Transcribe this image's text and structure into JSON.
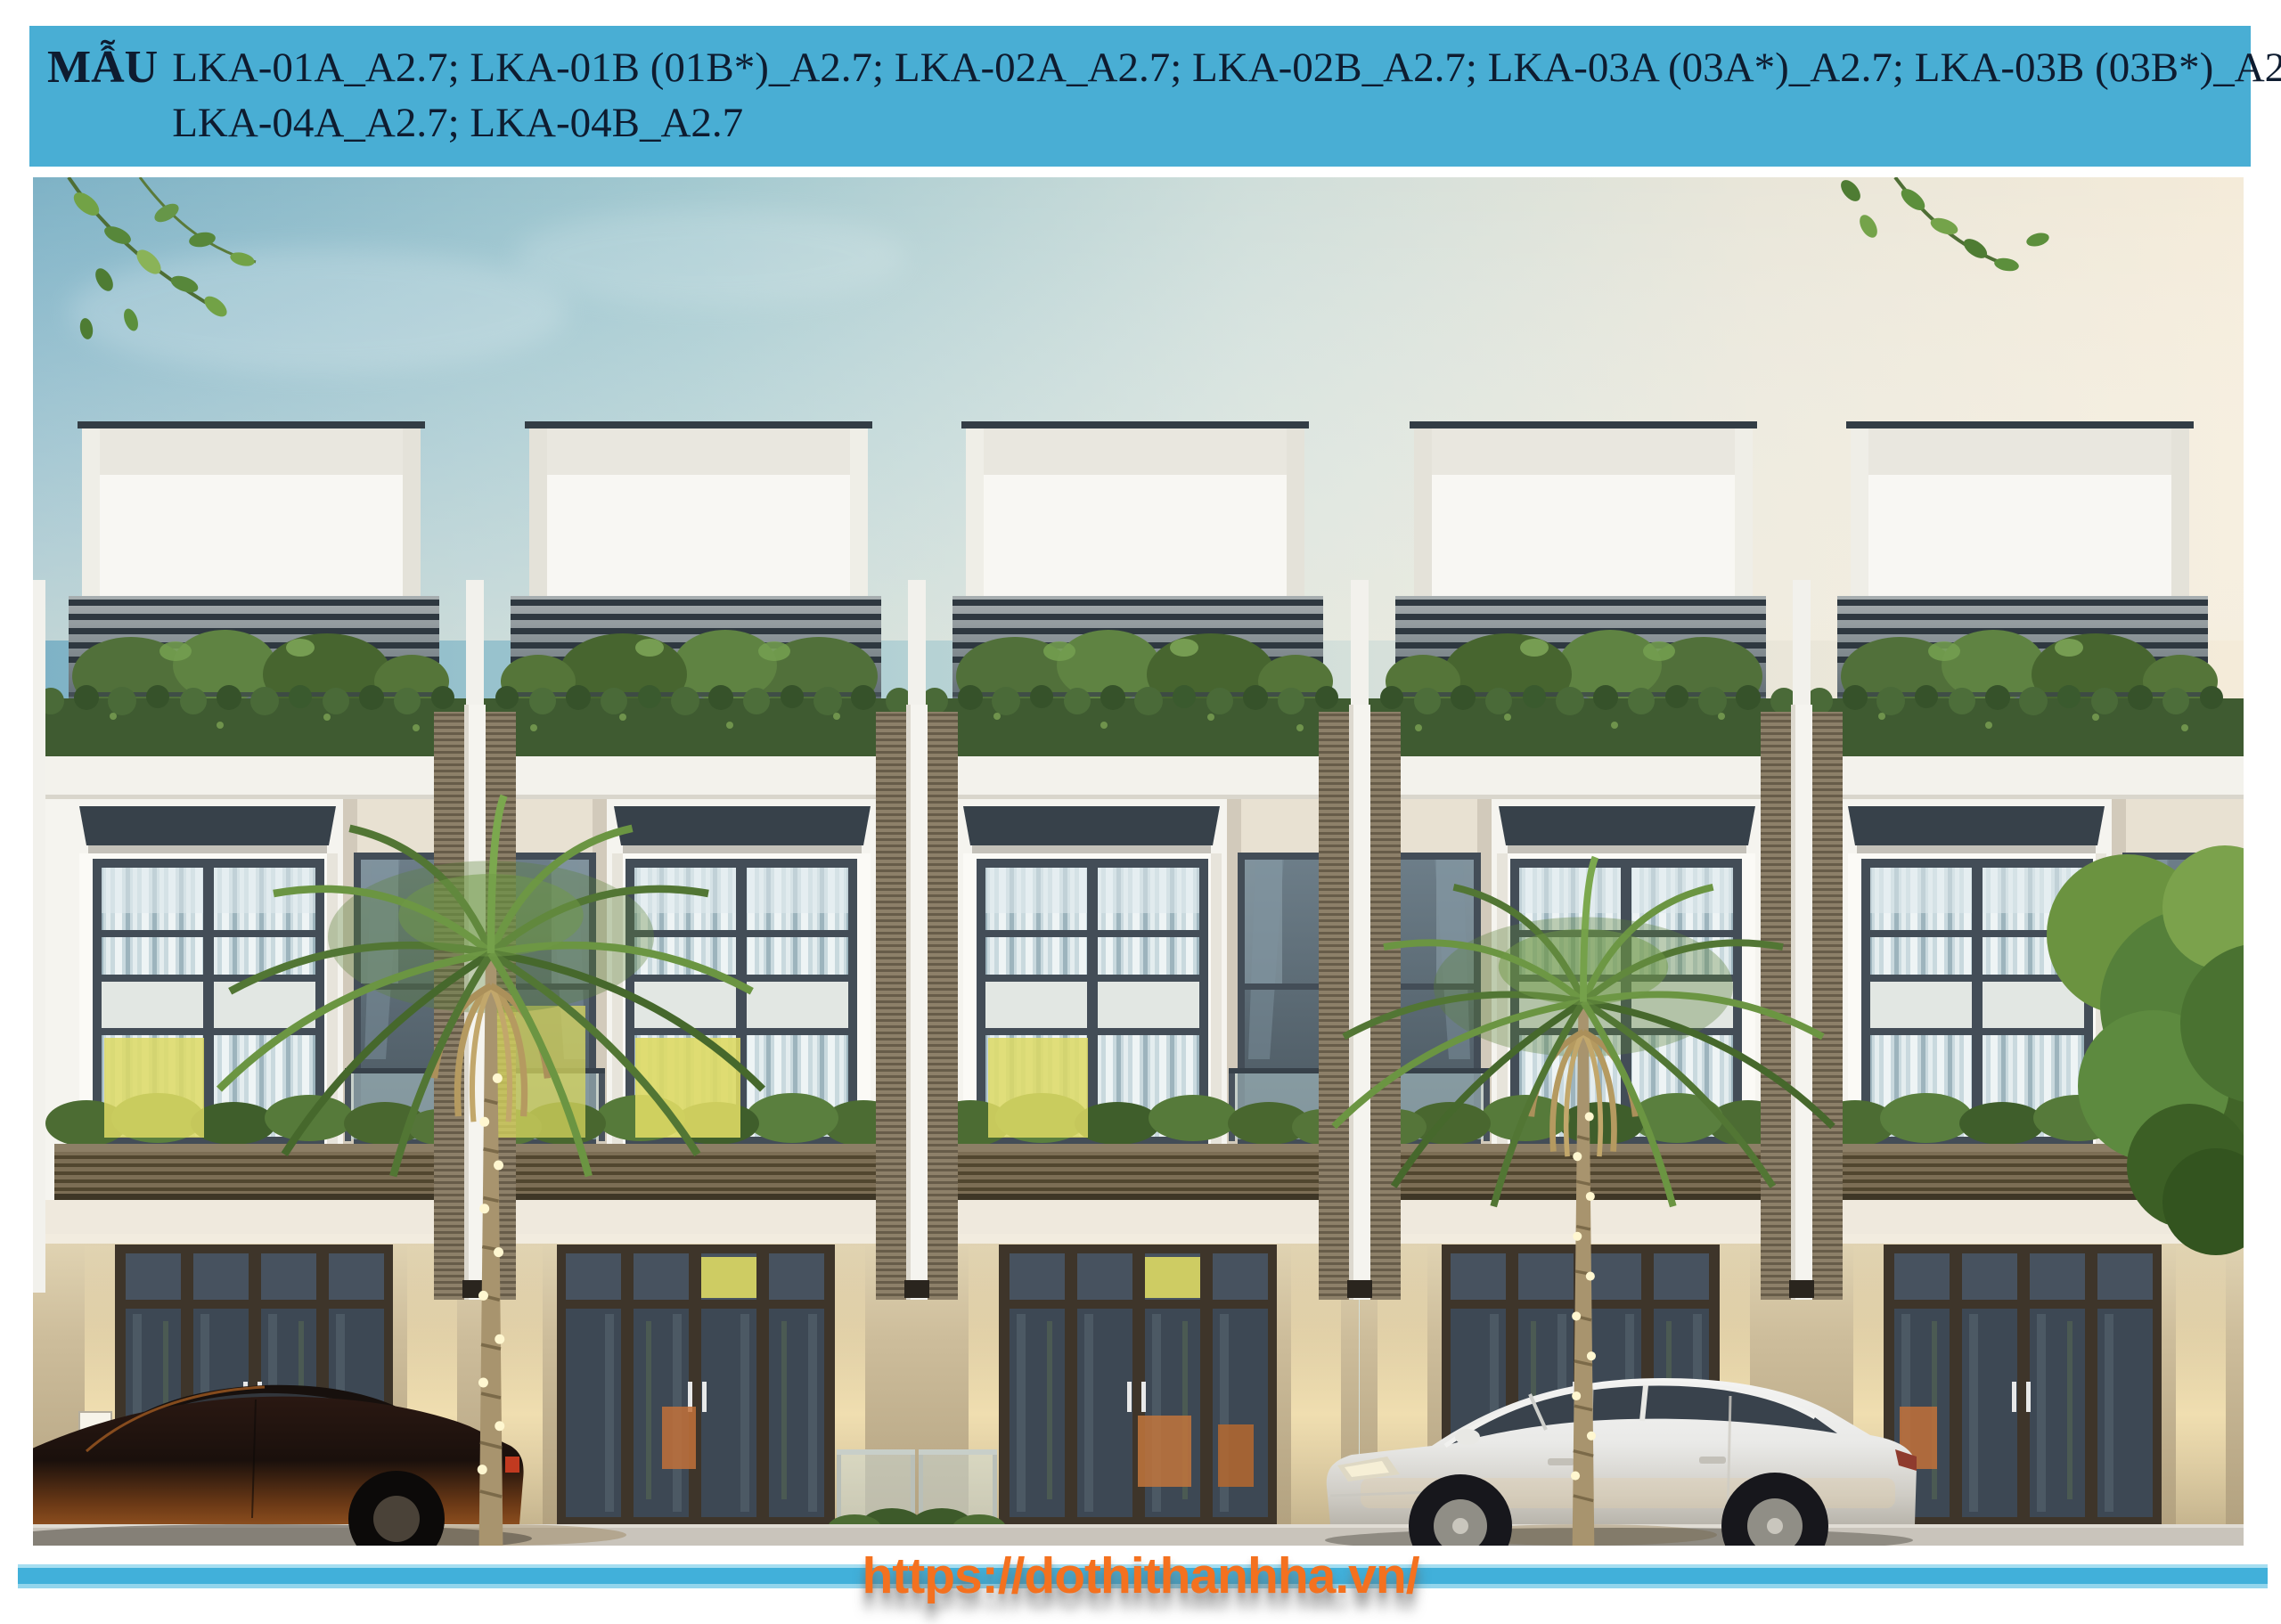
{
  "header": {
    "label": "MẪU",
    "models_line1": "LKA-01A_A2.7; LKA-01B (01B*)_A2.7; LKA-02A_A2.7; LKA-02B_A2.7; LKA-03A (03A*)_A2.7; LKA-03B (03B*)_A2.7;",
    "models_line2": "LKA-04A_A2.7; LKA-04B_A2.7",
    "models": [
      "LKA-01A_A2.7",
      "LKA-01B (01B*)_A2.7",
      "LKA-02A_A2.7",
      "LKA-02B_A2.7",
      "LKA-03A (03A*)_A2.7",
      "LKA-03B (03B*)_A2.7",
      "LKA-04A_A2.7",
      "LKA-04B_A2.7"
    ],
    "background_color": "#49aed4",
    "text_color": "#0e1c30"
  },
  "footer": {
    "url": "https://dothithanhha.vn/",
    "url_color": "#f4711f",
    "stripe_color": "#41b0da"
  },
  "scene": {
    "description": "Dusk rendering of a row of five modern white three-storey townhouses with roof-terrace pergolas, hedges, glass balconies with slatted planters, tall curtained windows (some lit yellow), beige shopfront ground floor with dark glazed doors, two fan palms wrapped in string lights, a dark sedan on the left and a white sedan at the right, leafy branches in the top corners and a green tree at the right edge.",
    "townhouse_units": 5,
    "palm_trees": 2,
    "cars": 2,
    "palette": {
      "sky_left": "#7eb2c6",
      "sky_right": "#f4ebd9",
      "facade_white": "#f5f4ef",
      "frame_dark": "#434d57",
      "hedge_green": "#3f5b31",
      "palm_green": "#5d8038",
      "palm_skirt_tan": "#b59a60",
      "planter_brown": "#7c6e55",
      "ground_beige": "#cdbd9b",
      "door_bronze": "#3e352a",
      "lit_window_yellow": "#ddd964",
      "white_car": "#eceded",
      "dark_car": "#241510"
    }
  }
}
